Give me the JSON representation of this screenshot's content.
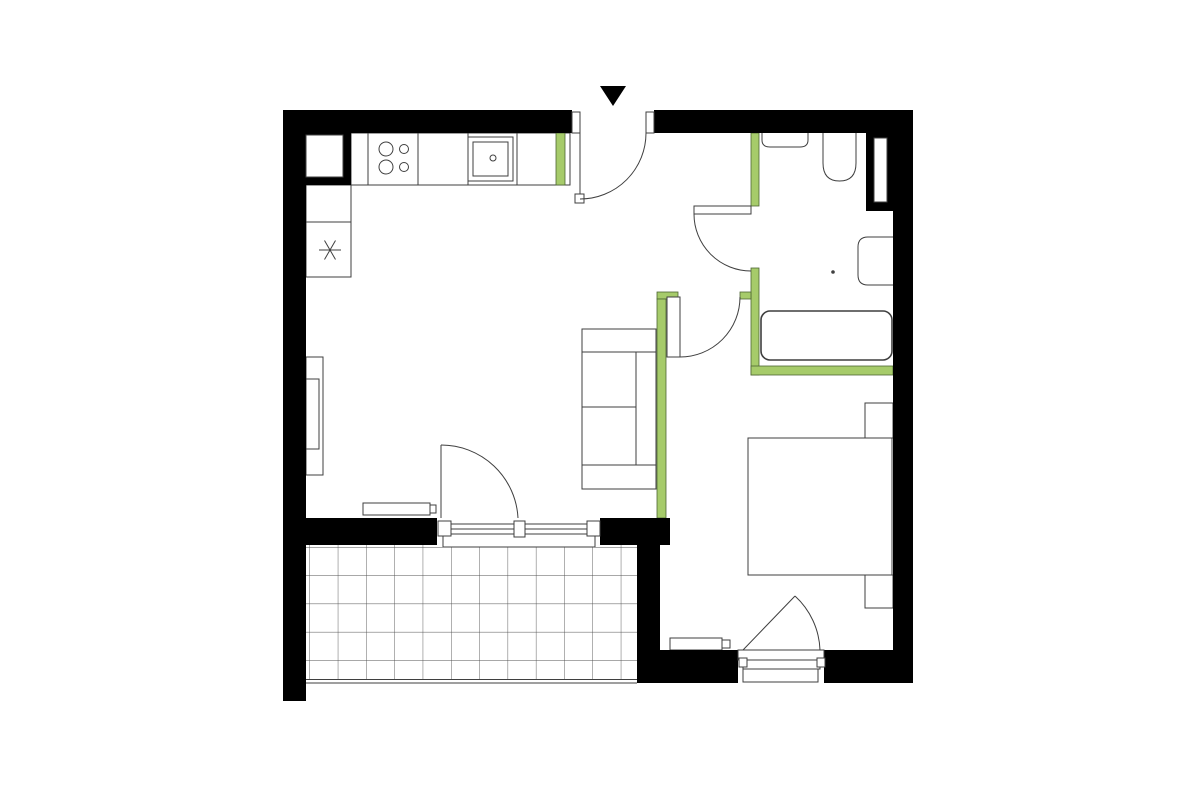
{
  "floorplan": {
    "colors": {
      "wall": "#000000",
      "line": "#3f3f3f",
      "accent-green": "#a6cb6a",
      "accent-green-border": "#4e6633",
      "tile-line": "#4f4f4f",
      "floor": "#ffffff"
    },
    "symbols": {
      "entrance_marker": "filled-down-triangle",
      "appliance_symbol": "six-spoke-asterisk"
    }
  }
}
